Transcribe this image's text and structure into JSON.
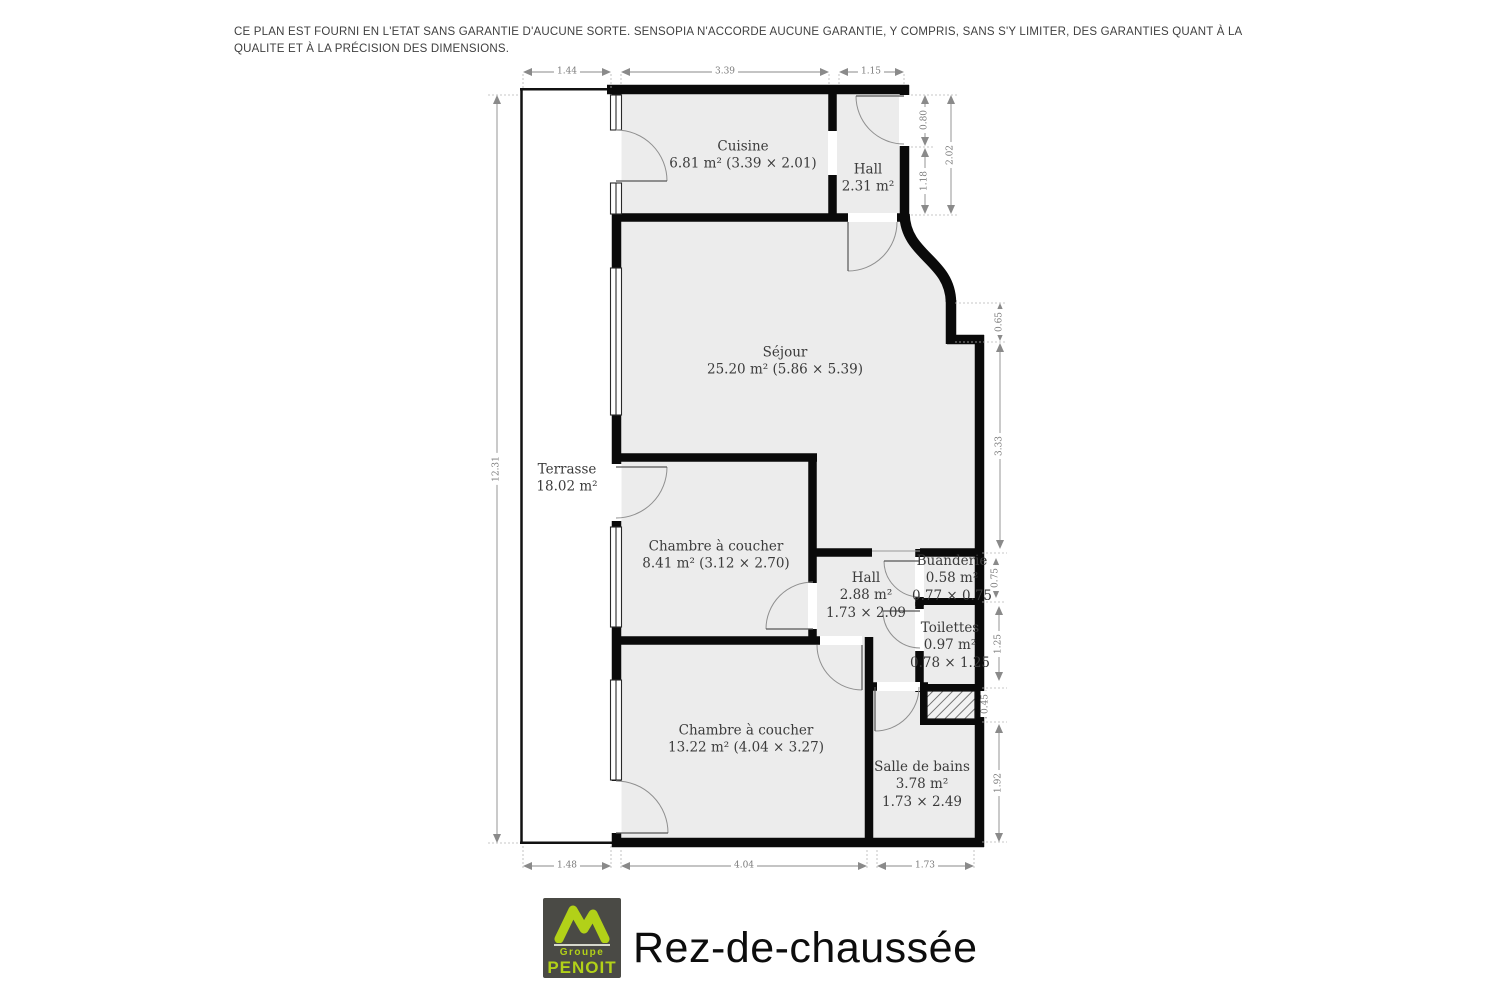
{
  "disclaimer": "CE PLAN EST FOURNI EN L'ETAT SANS GARANTIE D'AUCUNE SORTE. SENSOPIA N'ACCORDE AUCUNE GARANTIE, Y COMPRIS, SANS S'Y LIMITER, DES GARANTIES QUANT À LA QUALITE ET À LA PRÉCISION DES DIMENSIONS.",
  "floor_title": "Rez-de-chaussée",
  "logo": {
    "group": "Groupe",
    "name": "PENOIT",
    "accent": "#b2d118",
    "background": "#4a4a45"
  },
  "rooms": {
    "cuisine": {
      "name": "Cuisine",
      "area": "6.81 m² (3.39 × 2.01)"
    },
    "hall_entree": {
      "name": "Hall",
      "area": "2.31 m²"
    },
    "sejour": {
      "name": "Séjour",
      "area": "25.20 m² (5.86 × 5.39)"
    },
    "terrasse": {
      "name": "Terrasse",
      "area": "18.02 m²"
    },
    "chambre1": {
      "name": "Chambre à coucher",
      "area": "8.41 m² (3.12 × 2.70)"
    },
    "hall2": {
      "name": "Hall",
      "area": "2.88 m²",
      "dims": "1.73 × 2.09"
    },
    "buanderie": {
      "name": "Buanderie",
      "area": "0.58 m²",
      "dims": "0.77 × 0.75"
    },
    "toilettes": {
      "name": "Toilettes",
      "area": "0.97 m²",
      "dims": "0.78 × 1.25"
    },
    "chambre2": {
      "name": "Chambre à coucher",
      "area": "13.22 m² (4.04 × 3.27)"
    },
    "salle_de_bains": {
      "name": "Salle de bains",
      "area": "3.78 m²",
      "dims": "1.73 × 2.49"
    }
  },
  "dimensions": {
    "top": [
      "1.44",
      "3.39",
      "1.15"
    ],
    "bottom": [
      "1.48",
      "4.04",
      "1.73"
    ],
    "left": [
      "12.31"
    ],
    "right": [
      "0.80",
      "2.02",
      "1.18",
      "0.65",
      "3.33",
      "0.75",
      "1.25",
      "0.45",
      "1.92"
    ]
  }
}
